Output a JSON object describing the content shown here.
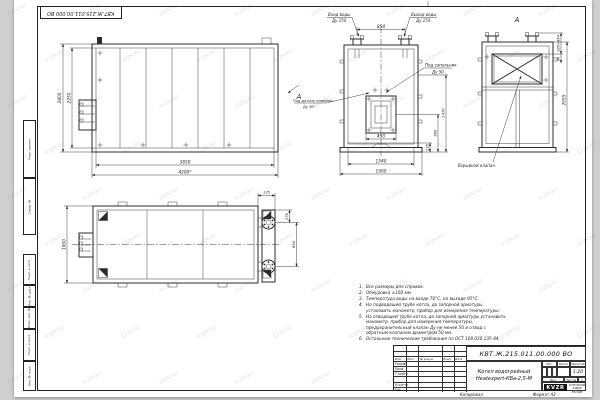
{
  "sheet": {
    "stamp_top": "КВТ.Ж.215.011.00.000 ВО",
    "copied_label": "Копировал",
    "format_label": "Формат А2",
    "watermark": "KVZR.RU"
  },
  "margin_boxes": [
    {
      "label": "Перв. примен."
    },
    {
      "label": "Справ. №"
    },
    {
      "label": "Подп. и дата"
    },
    {
      "label": "Инв. № дубл."
    },
    {
      "label": "Взам. инв. №"
    },
    {
      "label": "Подп. и дата"
    },
    {
      "label": "Инв. № подл."
    }
  ],
  "views": {
    "front": {
      "dim_height_outer": "2400",
      "dim_height_inner": "2250",
      "dim_width_inner": "3850",
      "dim_width_outer": "4200*",
      "section_label": "А"
    },
    "face": {
      "dim_pipes_span": "854",
      "dim_burner_width": "450",
      "dim_right_total": "1470",
      "dim_right_mid": "600",
      "dim_right_small": "135",
      "dim_base_width": "1540",
      "dim_total_width": "1900",
      "label_inlet": "Вход воды",
      "label_inlet_dn": "Ду 150",
      "label_outlet": "Выход воды",
      "label_outlet_dn": "Ду 150",
      "label_igniter": "Под запальник",
      "label_igniter_dn": "Ду 50",
      "label_flame": "Под датчик пламени",
      "label_flame_dn": "Ду 50"
    },
    "rear": {
      "view_title": "А",
      "dim_valve": "185×954",
      "dim_offset": "90",
      "dim_height": "2055",
      "label_valve": "Взрывной клапан"
    },
    "plan": {
      "dim_depth": "1900",
      "dim_edge": "135",
      "dim_pipe_offset": "276",
      "dim_pipes_span": "854"
    }
  },
  "notes": [
    {
      "num": "1.",
      "text": "Все размеры для справок."
    },
    {
      "num": "2.",
      "text": "Обмуровка ±100 мм."
    },
    {
      "num": "3.",
      "text": "Температура воды на входе 70°С, на выходе 95°С."
    },
    {
      "num": "4.",
      "text": "На подводящей трубе котла, до запорной арматуры установить манометр, прибор для измерения температуры."
    },
    {
      "num": "5.",
      "text": "На отводящей трубе котла, до запорной арматуры установить манометр, прибор для измерения температуры, предохранительный клапан Ду не менее 50 и отвод с обратным клапаном диаметром 50 мм."
    },
    {
      "num": "6.",
      "text": "Остальные технические требования по ОСТ 108.030.135-84."
    }
  ],
  "title_block": {
    "doc_number": "КВТ.Ж.215.011.00.000 ВО",
    "product_name_1": "Котел водогрейный",
    "product_name_2": "Heatexpert-КВа-2,5-М",
    "col_izm": "Изм.",
    "col_list": "Лист",
    "col_doc": "№ докум.",
    "col_sign": "Подп.",
    "col_date": "Дата",
    "row_developed": "Разраб.",
    "row_checked": "Пров.",
    "row_tcontrol": "Т.контр.",
    "row_ncontrol": "Н.контр.",
    "row_approved": "Утв.",
    "lit_label": "Лит.",
    "mass_label": "Масса",
    "scale_label": "Масштаб",
    "scale_value": "1:20",
    "sheet_label": "Лист",
    "sheets_label": "Листов",
    "sheets_value": "1",
    "logo_text": "KVZR",
    "company_line_1": "КОТЕЛЬНЫЙ",
    "company_line_2": "ЗАВОД РОССИИ"
  }
}
